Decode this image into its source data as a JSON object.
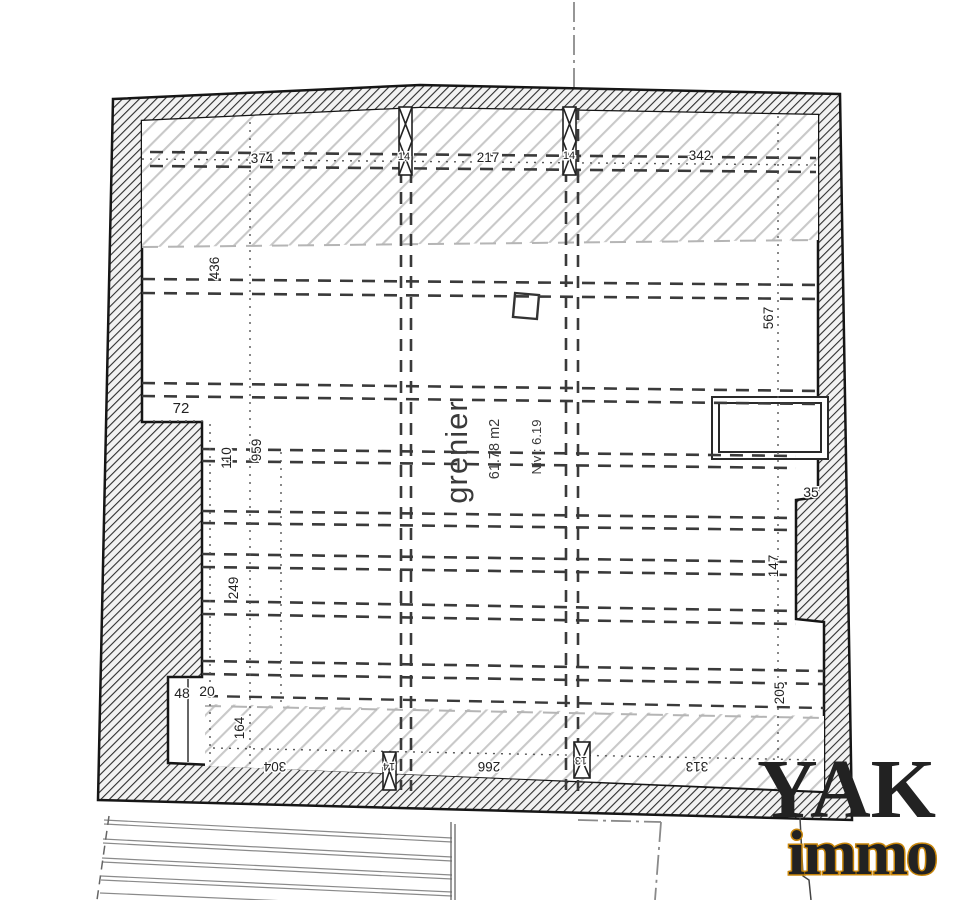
{
  "plan": {
    "room": {
      "name": "grenier",
      "area": "61.78 m2",
      "level": "Niv : 6.19"
    },
    "dimensions": {
      "top_left": "374",
      "top_center": "217",
      "top_right": "342",
      "left_upper": "436",
      "left_step": "72",
      "left_mid": "110",
      "left_length": "959",
      "left_lower_mid": "249",
      "left_lower": "164",
      "closet_left": "48",
      "closet_right": "20",
      "bottom_left": "304",
      "bottom_center": "266",
      "bottom_right": "313",
      "right_upper": "567",
      "right_step": "35",
      "right_mid": "147",
      "right_lower": "205",
      "post_top_left": "14",
      "post_top_center": "14",
      "post_bottom_left": "14",
      "post_bottom_center": "13"
    }
  },
  "logo": {
    "brand": "YAK",
    "sub": "immo",
    "brand_color": "#6B2E8E",
    "sub_color": "#FFD400",
    "sub_outline_color": "#C8860B"
  }
}
